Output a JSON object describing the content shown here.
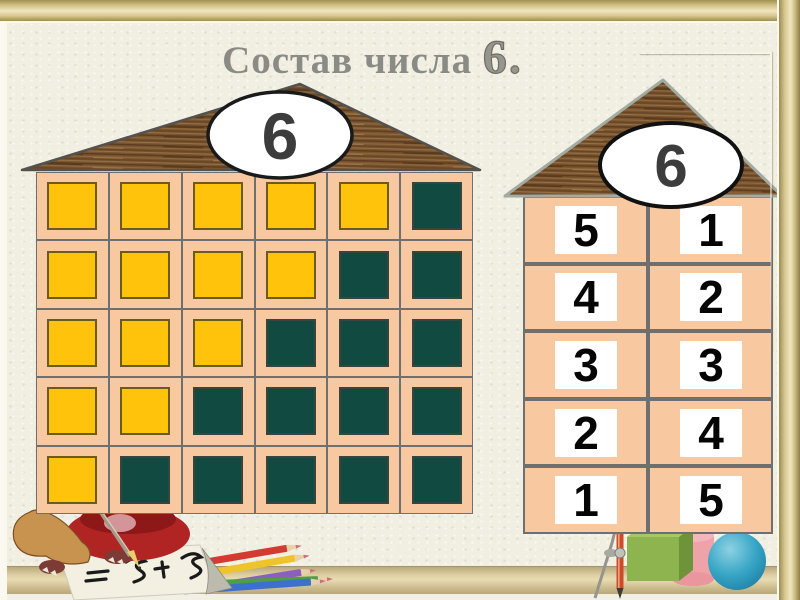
{
  "title": {
    "text": "Состав числа ",
    "suffix": "6."
  },
  "colors": {
    "background": "#f1eee2",
    "frame_gold": "#d8c78f",
    "floor": "#dccea2",
    "peach": "#f8c9a0",
    "yellow": "#ffc30b",
    "green": "#114a41",
    "cell_border": "#6f6f6f",
    "roof_brown": "#7a5530",
    "card_white": "#ffffff",
    "title_gray": "#8b8b85",
    "oval_number_gray": "#3c3c3c",
    "cube_green": "#8db44e",
    "cylinder_pink": "#efa3a8",
    "sphere_teal": "#2d9cbf"
  },
  "left_house": {
    "roof_label": "6",
    "columns": 6,
    "rows": [
      [
        "yellow",
        "yellow",
        "yellow",
        "yellow",
        "yellow",
        "green"
      ],
      [
        "yellow",
        "yellow",
        "yellow",
        "yellow",
        "green",
        "green"
      ],
      [
        "yellow",
        "yellow",
        "yellow",
        "green",
        "green",
        "green"
      ],
      [
        "yellow",
        "yellow",
        "green",
        "green",
        "green",
        "green"
      ],
      [
        "yellow",
        "green",
        "green",
        "green",
        "green",
        "green"
      ]
    ]
  },
  "right_house": {
    "roof_label": "6",
    "rows": [
      {
        "left": "5",
        "right": "1"
      },
      {
        "left": "4",
        "right": "2"
      },
      {
        "left": "3",
        "right": "3"
      },
      {
        "left": "2",
        "right": "4"
      },
      {
        "left": "1",
        "right": "5"
      }
    ]
  },
  "decorations": {
    "bottom_left": "owl-writing-with-colored-pencils",
    "pencil_colors": [
      "#d23b2f",
      "#efc32a",
      "#8a5fc0",
      "#4d9e44",
      "#3d6fd0"
    ],
    "bottom_right": [
      "drawing-compass",
      "green-cube",
      "pink-cylinder",
      "teal-sphere"
    ]
  }
}
